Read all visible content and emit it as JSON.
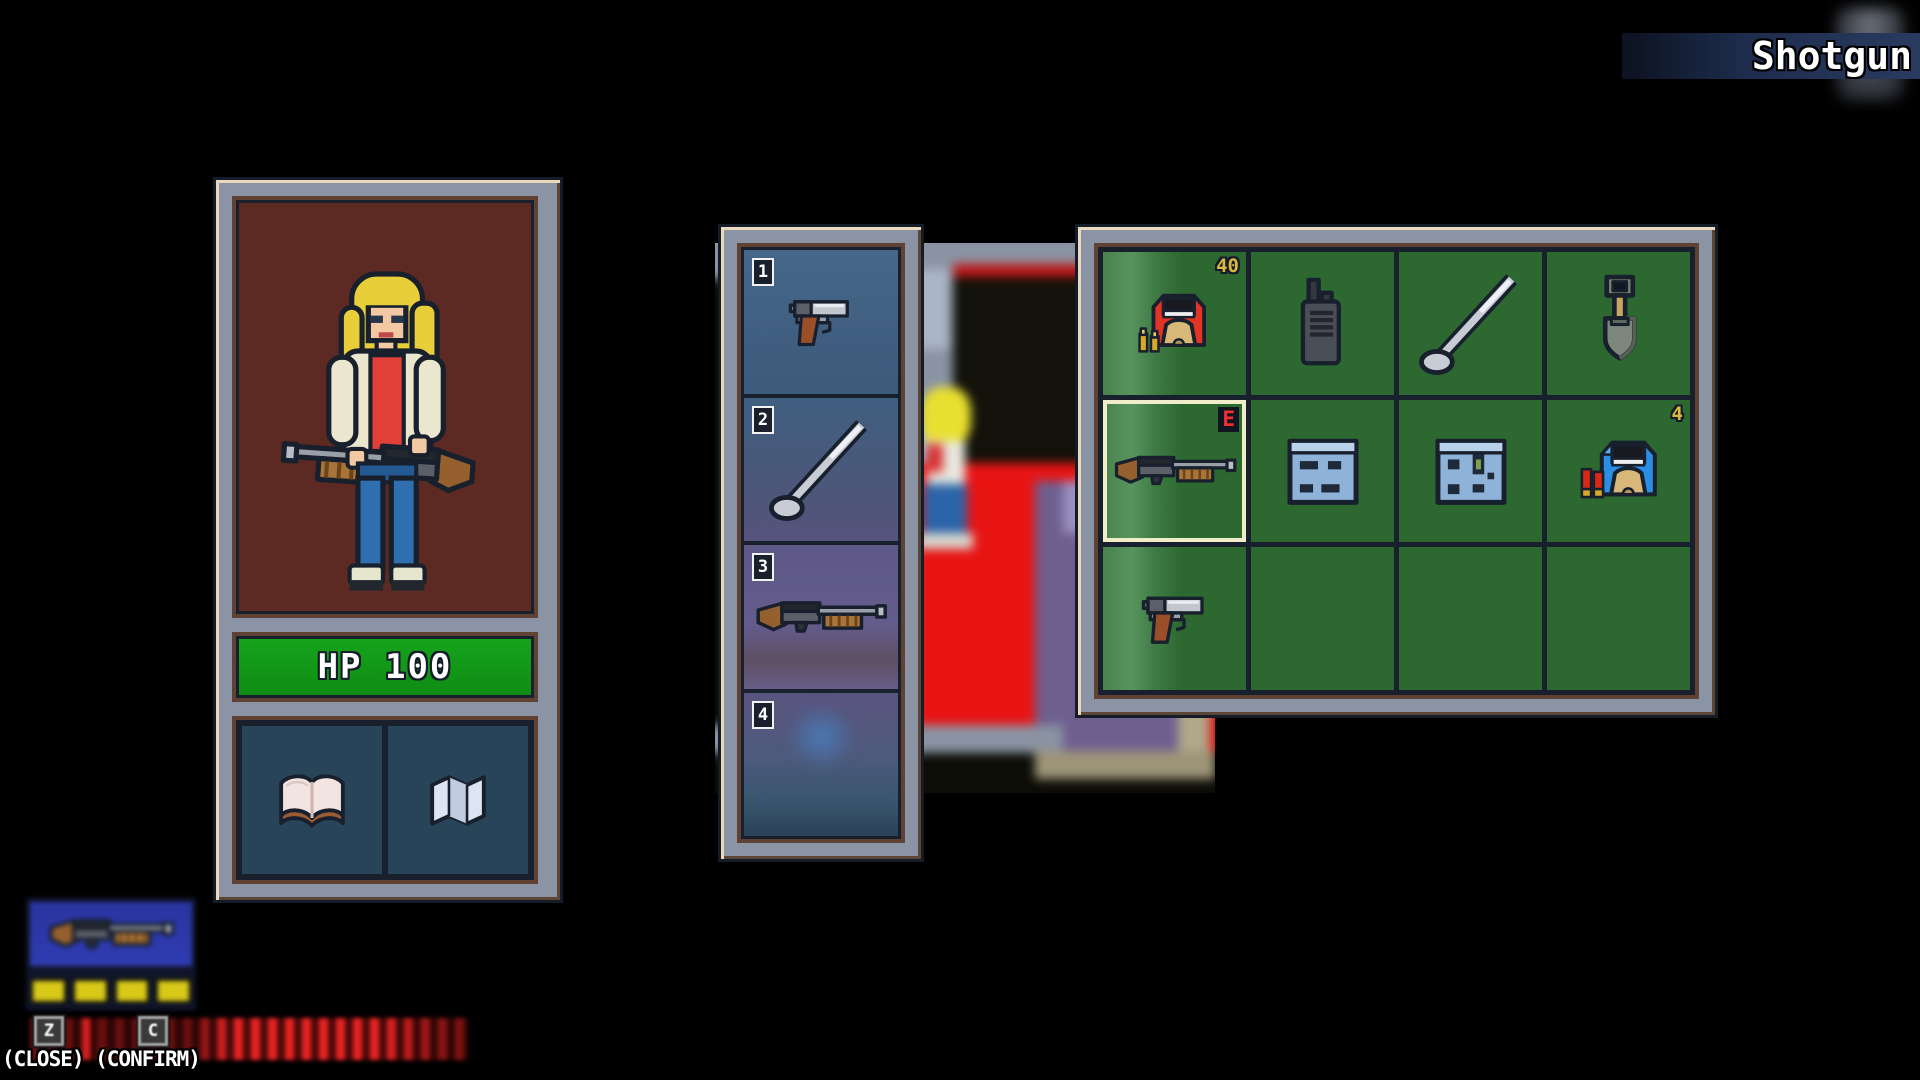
{
  "banner": {
    "item_name": "Shotgun"
  },
  "character_panel": {
    "portrait": "blonde-woman-holding-shotgun",
    "hp_text": "HP 100",
    "pocket_slots": [
      {
        "icon": "book"
      },
      {
        "icon": "map"
      }
    ]
  },
  "hotbar": {
    "slots": [
      {
        "number": "1",
        "item": "pistol"
      },
      {
        "number": "2",
        "item": "golf-club"
      },
      {
        "number": "3",
        "item": "shotgun"
      },
      {
        "number": "4",
        "item": ""
      }
    ]
  },
  "inventory": {
    "columns": 4,
    "rows": 3,
    "cells": [
      {
        "item": "shell-box-red",
        "count": "40"
      },
      {
        "item": "walkie-talkie"
      },
      {
        "item": "golf-club"
      },
      {
        "item": "shovel"
      },
      {
        "item": "shotgun",
        "badge": "E",
        "selected": true
      },
      {
        "item": "blue-note"
      },
      {
        "item": "blue-note-2"
      },
      {
        "item": "shell-box-blue",
        "count": "4"
      },
      {
        "item": "pistol"
      },
      {
        "item": ""
      },
      {
        "item": ""
      },
      {
        "item": ""
      }
    ]
  },
  "equipped_hud": {
    "weapon": "shotgun",
    "ammo_pips": "4"
  },
  "controls": {
    "keys": [
      {
        "key": "Z",
        "action": "close"
      },
      {
        "key": "C",
        "action": "confirm"
      }
    ],
    "hint": "(CLOSE) (CONFIRM)"
  },
  "colors": {
    "hp_green": "#12991a",
    "grid_green": "#2c6830",
    "selection_cream": "#f0eec8",
    "badge_red": "#f03030",
    "count_gold": "#d9b93f",
    "frame_gray": "#8b94a4",
    "frame_brown": "#5f4233",
    "frame_navy": "#18202e",
    "banner_blue": "#2a3b60"
  }
}
